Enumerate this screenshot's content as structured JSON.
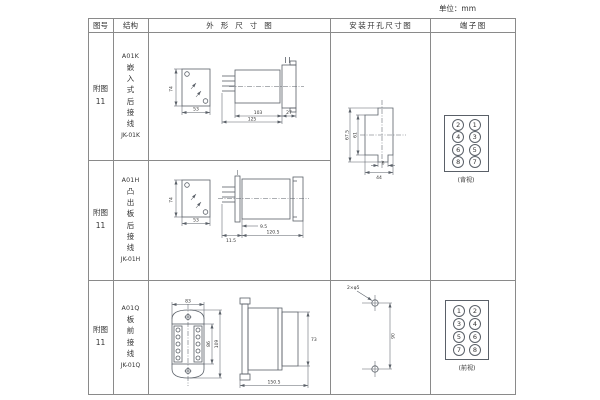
{
  "unit_label": "单位：mm",
  "header": {
    "fig_no": "图号",
    "structure": "结构",
    "outline": "外形尺寸图",
    "mounting": "安装开孔尺寸图",
    "terminal": "端子图"
  },
  "rows": [
    {
      "fig": "附图11",
      "model": "A01K",
      "desc": "嵌入式后接线",
      "code": "JK-01K"
    },
    {
      "fig": "附图11",
      "model": "A01H",
      "desc": "凸出板后接线",
      "code": "JK-01H"
    },
    {
      "fig": "附图11",
      "model": "A01Q",
      "desc": "板前接线",
      "code": "JK-01Q"
    }
  ],
  "diagrams": {
    "outline1": {
      "front_h": "74",
      "front_w": "53",
      "body": "103",
      "flange": "27",
      "total": "125"
    },
    "outline2": {
      "front_h": "74",
      "front_w": "53",
      "offset": "9.5",
      "plate": "11.5",
      "body": "120.5"
    },
    "outline3": {
      "top_w": "83",
      "inner_h": "86",
      "outer_h": "109",
      "side_h": "73",
      "side_w": "150.5"
    },
    "mounting12": {
      "outer_h": "67.5",
      "inner_h": "61",
      "tab_w": "6",
      "cutout_w": "44"
    },
    "mounting3": {
      "callout": "2×φ5",
      "spacing": "90"
    },
    "terminal12": {
      "cells": [
        "2",
        "1",
        "4",
        "3",
        "6",
        "5",
        "8",
        "7"
      ],
      "caption": "(背视)"
    },
    "terminal3": {
      "cells": [
        "1",
        "2",
        "3",
        "4",
        "5",
        "6",
        "7",
        "8"
      ],
      "caption": "(前视)"
    }
  }
}
